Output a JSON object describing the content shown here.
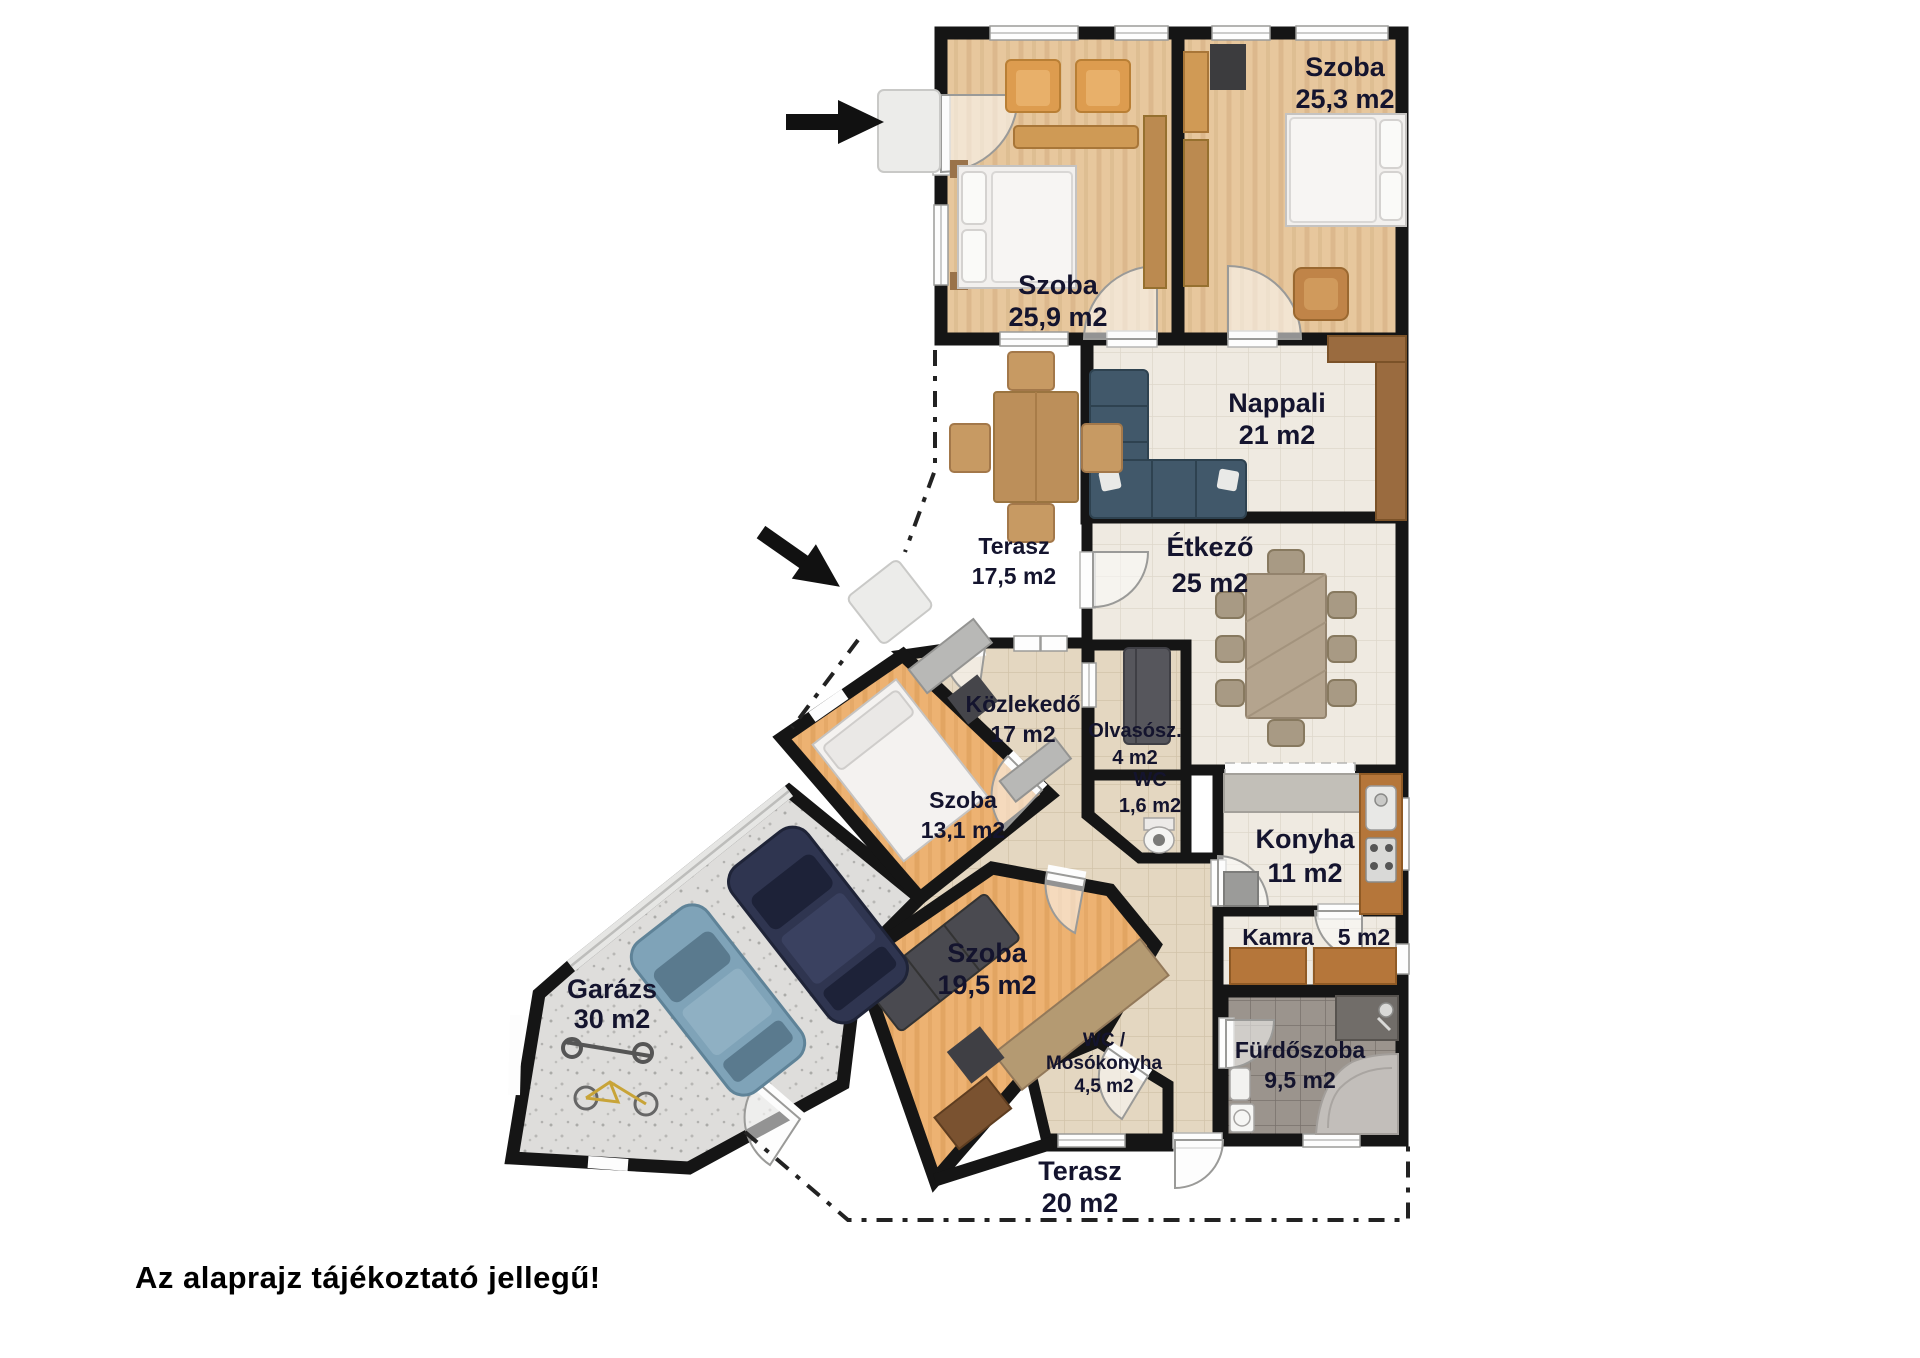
{
  "disclaimer": "Az alaprajz tájékoztató jellegű!",
  "rooms": {
    "szoba1": {
      "name": "Szoba",
      "area": "25,9 m2"
    },
    "szoba2": {
      "name": "Szoba",
      "area": "25,3 m2"
    },
    "nappali": {
      "name": "Nappali",
      "area": "21 m2"
    },
    "terasz1": {
      "name": "Terasz",
      "area": "17,5 m2"
    },
    "etkezo": {
      "name": "Étkező",
      "area": "25 m2"
    },
    "kozlekedo": {
      "name": "Közlekedő",
      "area": "17 m2"
    },
    "olvaso": {
      "name": "Olvasósz.",
      "area": "4 m2"
    },
    "wc": {
      "name": "WC",
      "area": "1,6 m2"
    },
    "konyha": {
      "name": "Konyha",
      "area": "11 m2"
    },
    "szoba3": {
      "name": "Szoba",
      "area": "13,1 m2"
    },
    "kamra": {
      "name": "Kamra",
      "area": "5 m2"
    },
    "garazs": {
      "name": "Garázs",
      "area": "30 m2"
    },
    "szoba4": {
      "name": "Szoba",
      "area": "19,5 m2"
    },
    "wcmoso": {
      "line1": "WC /",
      "line2": "Mosókonyha",
      "area": "4,5 m2"
    },
    "furdo": {
      "name": "Fürdőszoba",
      "area": "9,5 m2"
    },
    "terasz2": {
      "name": "Terasz",
      "area": "20 m2"
    }
  },
  "icons": {
    "entrance_arrow_main": "arrow-right",
    "entrance_arrow_terrace": "arrow-down-right"
  },
  "colors": {
    "wall": "#151515",
    "label": "#14142e",
    "wood": "#e7c79d",
    "wood_orange": "#edb272",
    "cream": "#efeae1",
    "beige": "#e4d7c1",
    "garage_floor": "#dedddb",
    "bath_floor": "#9b948d",
    "sofa_teal": "#41586a",
    "cabinet_brown": "#b5763a"
  }
}
